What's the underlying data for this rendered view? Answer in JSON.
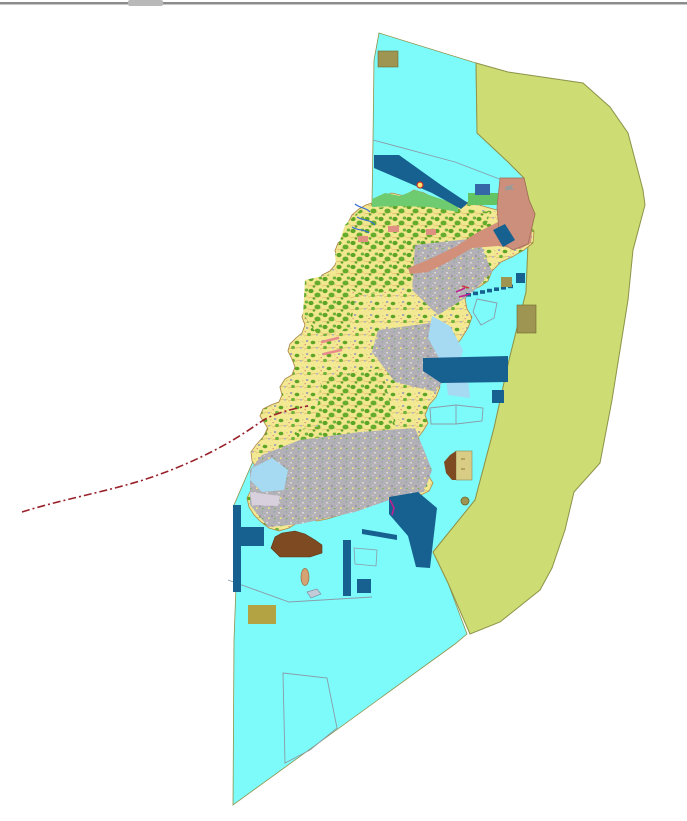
{
  "page": {
    "background": "#FFFFFF",
    "top_border_color": "#8C8C8C",
    "top_border_highlight": "#C6C6C6",
    "top_notch_color": "#B9B9B9"
  },
  "colors": {
    "water": "#7DFBFB",
    "buffer": "#CDDC73",
    "buffer_stroke": "#8E9349",
    "island_base": "#F2E992",
    "coast_stroke": "#B08948",
    "forest": "#5CA426",
    "urban": "#B3B0B6",
    "navy": "#16618F",
    "navy_bright": "#3566A6",
    "salmon": "#CC8F7B",
    "salmon_band": "#D2907A",
    "salmon_spot": "#E09080",
    "green_strip": "#6FCB70",
    "green_rect": "#62C462",
    "khaki": "#9E9552",
    "khaki_gold": "#B3A343",
    "khaki_pale": "#D9CD85",
    "brown": "#7D4A21",
    "red_line": "#99222A",
    "pink": "#E98B8B",
    "river": "#3A6FD0",
    "light_blue": "#A6D9F2",
    "lavender": "#D8D0DC",
    "outline": "#8A9BA8",
    "tan_islet": "#D4A273",
    "gray_islet": "#C3CBD9",
    "magenta": "#C02090",
    "symbol_fill": "#FFE36A",
    "symbol_stroke": "#C03030",
    "arrow_gray": "#9A9A9A"
  },
  "features": [
    {
      "name": "marine-zone",
      "color": "water"
    },
    {
      "name": "eastern-buffer-zone",
      "color": "buffer"
    },
    {
      "name": "island-landmass",
      "color": "island_base"
    },
    {
      "name": "forest-areas",
      "color": "forest"
    },
    {
      "name": "urban-areas",
      "color": "urban"
    },
    {
      "name": "northeast-district",
      "color": "salmon"
    },
    {
      "name": "port-facilities",
      "color": "navy"
    },
    {
      "name": "reclaimed-port-area",
      "color": "brown"
    },
    {
      "name": "boundary-line",
      "color": "red_line",
      "style": "dash-dot"
    }
  ]
}
